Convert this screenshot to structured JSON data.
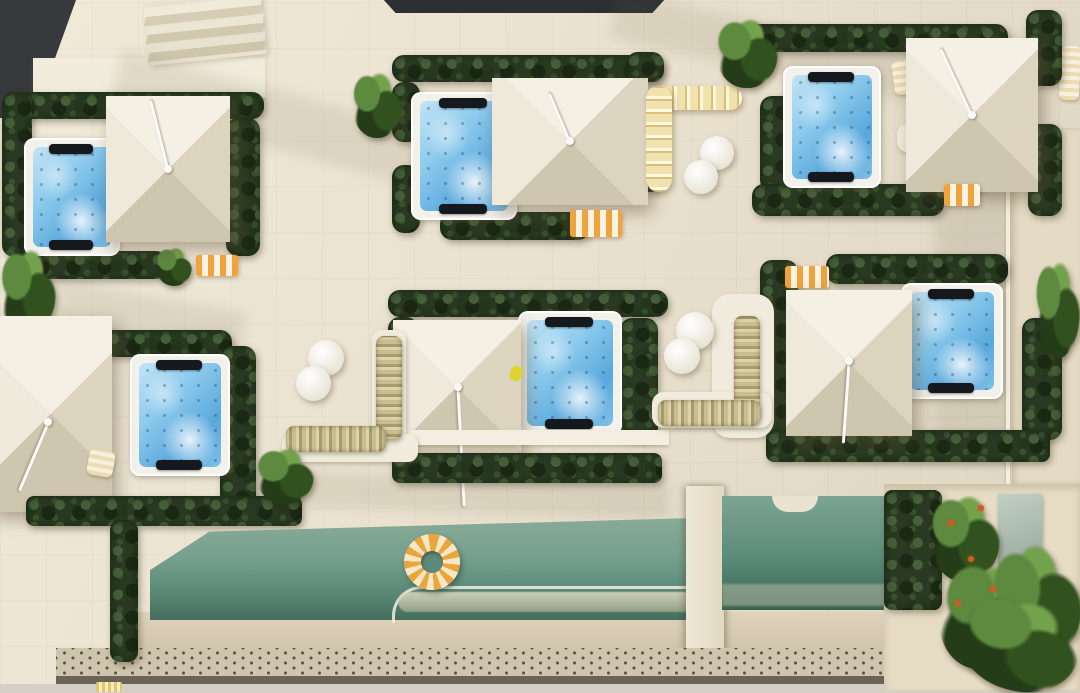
{
  "scene": {
    "description": "Aerial top-down photorealistic 3D architectural rendering of a boutique hotel rooftop terrace: six private hot-tub patios framed by hedges with white pyramid canopy umbrellas, orange striped awnings, scalloped banquettes and round tables, above a long communal pool deck with a striped ring float and a tropical garden",
    "time_of_day": "sunny daytime, shadows cast toward lower-right",
    "text_content": "none — image contains no text"
  },
  "palette": {
    "deck_cream": "#eae2cf",
    "wall_light": "#f2ecdc",
    "shadow_tone": "#c9bca0",
    "dark_roof": "#37393c",
    "hedge_dark": "#2a3a22",
    "hedge_light": "#46603a",
    "tub_rim_white": "#f2f1ea",
    "tub_water_blue": "#8ecbed",
    "umbrella_canvas": "#eee9db",
    "awning_orange": "#f0a33c",
    "banquette_yellow": "#f0e2ad",
    "cushion_olive": "#a79c6e",
    "pool_teal": "#6f9c8a",
    "pool_deep": "#446e5d",
    "float_orange": "#eaa53d",
    "flower_orange": "#d2591f"
  },
  "objects": {
    "hot_tub": {
      "label": "private hot tub with jets and black headrests",
      "count": 6
    },
    "umbrella": {
      "label": "white square pyramid canopy umbrella",
      "count": 6
    },
    "hedge": {
      "label": "dark green privacy hedge border",
      "count": 20
    },
    "pool_main": {
      "label": "long communal pool with underwater bench",
      "count": 1
    },
    "pool_right": {
      "label": "secondary pool section beside tropical garden",
      "count": 1
    },
    "pool_float": {
      "label": "orange-and-cream striped ring float",
      "count": 1
    },
    "round_table": {
      "label": "round white side table",
      "count": 6
    },
    "banquette": {
      "label": "pale-yellow scalloped curved banquette",
      "count": 1
    },
    "cushion_bench": {
      "label": "L-shaped bench with olive striped cushions",
      "count": 2
    },
    "awning": {
      "label": "orange-and-white striped awning",
      "count": 4
    },
    "stairs": {
      "label": "rooftop access staircase",
      "count": 1
    },
    "bridge": {
      "label": "walkway bridge crossing the pool",
      "count": 1
    },
    "tropical_garden": {
      "label": "tropical planting bed with orange flowers and palms",
      "count": 1
    },
    "dotted_deck": {
      "label": "perforated drainage deck strip",
      "count": 1
    },
    "dark_roof": {
      "label": "adjacent dark rooftop",
      "count": 2
    }
  }
}
